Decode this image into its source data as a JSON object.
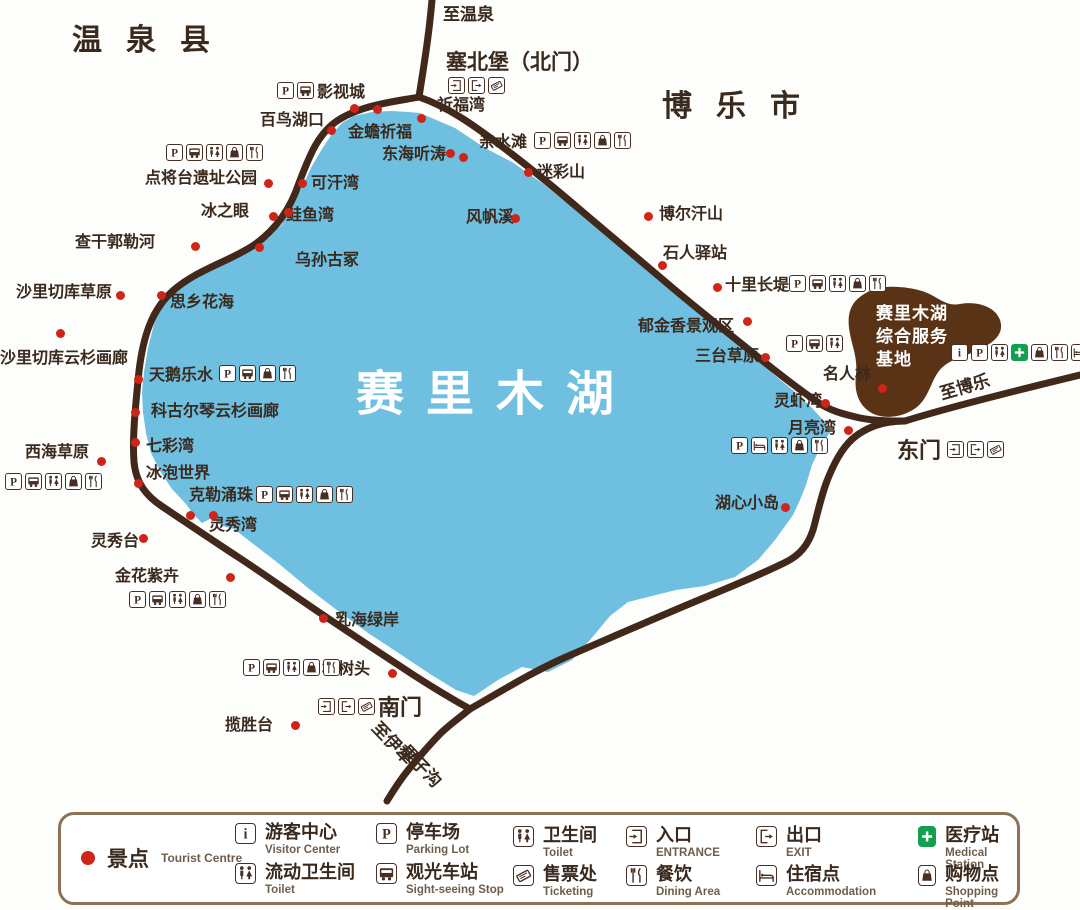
{
  "colors": {
    "lake": "#6fbfe0",
    "road": "#42281a",
    "text": "#3a2a1e",
    "dot_red": "#cf2418",
    "service_base_brown": "#5a3317",
    "legend_border": "#8d7258",
    "medical_green": "#12a04f"
  },
  "map": {
    "lake_title": "赛里木湖",
    "base_label": "赛里木湖\n综合服务\n基地",
    "regions": [
      {
        "text": "温泉县",
        "x": 72,
        "y": 24
      },
      {
        "text": "博乐市",
        "x": 662,
        "y": 90
      }
    ],
    "road_labels": [
      {
        "text": "至温泉",
        "x": 443,
        "y": 6,
        "rot": 0
      },
      {
        "text": "至博乐",
        "x": 938,
        "y": 386,
        "rot": -16
      },
      {
        "text": "至伊犁",
        "x": 381,
        "y": 719,
        "rot": 46
      },
      {
        "text": "果子沟",
        "x": 409,
        "y": 742,
        "rot": 46
      }
    ],
    "gates": [
      {
        "text": "塞北堡（北门）",
        "x": 446,
        "y": 51,
        "small": true
      },
      {
        "text": "东门",
        "x": 897,
        "y": 439,
        "small": false
      },
      {
        "text": "南门",
        "x": 378,
        "y": 696,
        "small": false
      }
    ],
    "pois": [
      {
        "text": "祈福湾",
        "x": 437,
        "y": 97
      },
      {
        "text": "影视城",
        "x": 317,
        "y": 84
      },
      {
        "text": "百鸟湖口",
        "x": 260,
        "y": 112
      },
      {
        "text": "金蟾祈福",
        "x": 348,
        "y": 124
      },
      {
        "text": "东海听涛",
        "x": 382,
        "y": 146
      },
      {
        "text": "亲水滩",
        "x": 479,
        "y": 134
      },
      {
        "text": "迷彩山",
        "x": 537,
        "y": 164
      },
      {
        "text": "可汗湾",
        "x": 311,
        "y": 175
      },
      {
        "text": "冰之眼",
        "x": 201,
        "y": 203
      },
      {
        "text": "鲑鱼湾",
        "x": 286,
        "y": 207
      },
      {
        "text": "点将台遗址公园",
        "x": 145,
        "y": 170
      },
      {
        "text": "查干郭勒河",
        "x": 75,
        "y": 234
      },
      {
        "text": "乌孙古冢",
        "x": 295,
        "y": 252
      },
      {
        "text": "风帆溪",
        "x": 466,
        "y": 209
      },
      {
        "text": "博尔汗山",
        "x": 659,
        "y": 206
      },
      {
        "text": "石人驿站",
        "x": 663,
        "y": 245
      },
      {
        "text": "沙里切库草原",
        "x": 16,
        "y": 284
      },
      {
        "text": "思乡花海",
        "x": 170,
        "y": 294
      },
      {
        "text": "十里长堤",
        "x": 725,
        "y": 277
      },
      {
        "text": "沙里切库云杉画廊",
        "x": 0,
        "y": 350
      },
      {
        "text": "郁金香景观区",
        "x": 638,
        "y": 318
      },
      {
        "text": "三台草原",
        "x": 695,
        "y": 348
      },
      {
        "text": "名人林",
        "x": 823,
        "y": 366
      },
      {
        "text": "天鹅乐水",
        "x": 149,
        "y": 367
      },
      {
        "text": "科古尔琴云杉画廊",
        "x": 151,
        "y": 403
      },
      {
        "text": "灵虾湾",
        "x": 774,
        "y": 393
      },
      {
        "text": "七彩湾",
        "x": 146,
        "y": 438
      },
      {
        "text": "西海草原",
        "x": 25,
        "y": 444
      },
      {
        "text": "月亮湾",
        "x": 788,
        "y": 420
      },
      {
        "text": "冰泡世界",
        "x": 146,
        "y": 465
      },
      {
        "text": "克勒涌珠",
        "x": 189,
        "y": 487
      },
      {
        "text": "湖心小岛",
        "x": 715,
        "y": 495
      },
      {
        "text": "灵秀湾",
        "x": 209,
        "y": 517
      },
      {
        "text": "灵秀台",
        "x": 91,
        "y": 533
      },
      {
        "text": "金花紫卉",
        "x": 115,
        "y": 568
      },
      {
        "text": "乳海绿岸",
        "x": 335,
        "y": 612
      },
      {
        "text": "松树头",
        "x": 322,
        "y": 661
      },
      {
        "text": "揽胜台",
        "x": 225,
        "y": 717
      }
    ],
    "dots": [
      [
        354,
        108
      ],
      [
        377,
        109
      ],
      [
        331,
        130
      ],
      [
        421,
        118
      ],
      [
        450,
        153
      ],
      [
        463,
        157
      ],
      [
        528,
        172
      ],
      [
        268,
        183
      ],
      [
        302,
        183
      ],
      [
        273,
        216
      ],
      [
        288,
        212
      ],
      [
        195,
        246
      ],
      [
        259,
        247
      ],
      [
        120,
        295
      ],
      [
        161,
        295
      ],
      [
        60,
        333
      ],
      [
        138,
        379
      ],
      [
        135,
        412
      ],
      [
        135,
        442
      ],
      [
        101,
        461
      ],
      [
        138,
        483
      ],
      [
        190,
        515
      ],
      [
        213,
        515
      ],
      [
        143,
        538
      ],
      [
        230,
        577
      ],
      [
        323,
        618
      ],
      [
        392,
        673
      ],
      [
        295,
        725
      ],
      [
        648,
        216
      ],
      [
        662,
        265
      ],
      [
        717,
        287
      ],
      [
        747,
        321
      ],
      [
        765,
        357
      ],
      [
        825,
        403
      ],
      [
        848,
        430
      ],
      [
        785,
        507
      ],
      [
        882,
        388
      ],
      [
        515,
        218
      ]
    ],
    "facility_rows": [
      {
        "x": 277,
        "y": 82,
        "icons": [
          "parking",
          "bus"
        ]
      },
      {
        "x": 448,
        "y": 77,
        "icons": [
          "entrance",
          "exit",
          "ticket"
        ]
      },
      {
        "x": 166,
        "y": 144,
        "icons": [
          "parking",
          "bus",
          "toilet",
          "shopping",
          "dining"
        ]
      },
      {
        "x": 534,
        "y": 132,
        "icons": [
          "parking",
          "bus",
          "toilet",
          "shopping",
          "dining"
        ]
      },
      {
        "x": 789,
        "y": 275,
        "icons": [
          "parking",
          "bus",
          "toilet",
          "shopping",
          "dining"
        ]
      },
      {
        "x": 786,
        "y": 335,
        "icons": [
          "parking",
          "bus",
          "toilet"
        ]
      },
      {
        "x": 219,
        "y": 365,
        "icons": [
          "parking",
          "bus",
          "shopping",
          "dining"
        ]
      },
      {
        "x": 5,
        "y": 473,
        "icons": [
          "parking",
          "bus",
          "toilet",
          "shopping",
          "dining"
        ]
      },
      {
        "x": 256,
        "y": 486,
        "icons": [
          "parking",
          "bus",
          "toilet",
          "shopping",
          "dining"
        ]
      },
      {
        "x": 731,
        "y": 437,
        "icons": [
          "parking",
          "bed",
          "toilet",
          "shopping",
          "dining"
        ]
      },
      {
        "x": 129,
        "y": 591,
        "icons": [
          "parking",
          "bus",
          "toilet",
          "shopping",
          "dining"
        ]
      },
      {
        "x": 243,
        "y": 659,
        "icons": [
          "parking",
          "bus",
          "toilet",
          "shopping",
          "dining"
        ]
      },
      {
        "x": 318,
        "y": 698,
        "icons": [
          "entrance",
          "exit",
          "ticket"
        ]
      },
      {
        "x": 947,
        "y": 441,
        "icons": [
          "entrance",
          "exit",
          "ticket"
        ]
      },
      {
        "x": 951,
        "y": 344,
        "icons": [
          "info",
          "parking",
          "toilet",
          "medical",
          "shopping",
          "dining",
          "bed"
        ]
      }
    ]
  },
  "legend": {
    "spot": {
      "zh": "景点",
      "en": "Tourist Centre"
    },
    "items": [
      {
        "icon": "info",
        "zh": "游客中心",
        "en": "Visitor Center",
        "x": 174,
        "y": 8
      },
      {
        "icon": "toilet",
        "zh": "流动卫生间",
        "en": "Toilet",
        "x": 174,
        "y": 48
      },
      {
        "icon": "parking",
        "zh": "停车场",
        "en": "Parking Lot",
        "x": 315,
        "y": 8
      },
      {
        "icon": "bus",
        "zh": "观光车站",
        "en": "Sight-seeing Stop",
        "x": 315,
        "y": 48
      },
      {
        "icon": "toilet",
        "zh": "卫生间",
        "en": "Toilet",
        "x": 452,
        "y": 11
      },
      {
        "icon": "ticket",
        "zh": "售票处",
        "en": "Ticketing",
        "x": 452,
        "y": 50
      },
      {
        "icon": "entrance",
        "zh": "入口",
        "en": "ENTRANCE",
        "x": 565,
        "y": 11
      },
      {
        "icon": "dining",
        "zh": "餐饮",
        "en": "Dining Area",
        "x": 565,
        "y": 50
      },
      {
        "icon": "exit",
        "zh": "出口",
        "en": "EXIT",
        "x": 695,
        "y": 11
      },
      {
        "icon": "bed",
        "zh": "住宿点",
        "en": "Accommodation",
        "x": 695,
        "y": 50
      },
      {
        "icon": "medical",
        "zh": "医疗站",
        "en": "Medical Station",
        "x": 857,
        "y": 11
      },
      {
        "icon": "shopping",
        "zh": "购物点",
        "en": "Shopping Point",
        "x": 857,
        "y": 50
      }
    ]
  }
}
